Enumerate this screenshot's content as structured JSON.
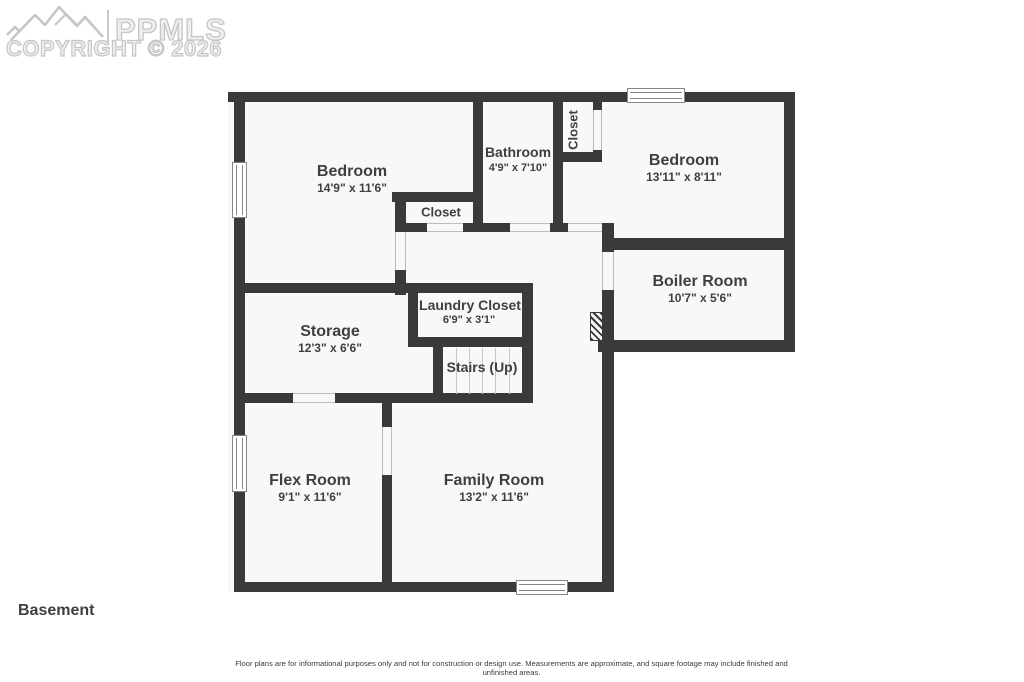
{
  "watermark": {
    "brand": "PPMLS",
    "copyright": "COPYRIGHT © 2026"
  },
  "floor_label": "Basement",
  "disclaimer": "Floor plans are for informational purposes only and not for construction or design use. Measurements are approximate, and square footage may include finished and unfinished areas.",
  "rooms": {
    "bedroom1": {
      "name": "Bedroom",
      "dims": "14'9\" x 11'6\""
    },
    "bathroom": {
      "name": "Bathroom",
      "dims": "4'9\" x 7'10\""
    },
    "closet_b2": {
      "name": "Closet"
    },
    "bedroom2": {
      "name": "Bedroom",
      "dims": "13'11\" x 8'11\""
    },
    "closet_hall": {
      "name": "Closet"
    },
    "boiler": {
      "name": "Boiler Room",
      "dims": "10'7\" x 5'6\""
    },
    "laundry": {
      "name": "Laundry Closet",
      "dims": "6'9\" x 3'1\""
    },
    "storage": {
      "name": "Storage",
      "dims": "12'3\" x 6'6\""
    },
    "stairs": {
      "name": "Stairs (Up)"
    },
    "flex": {
      "name": "Flex Room",
      "dims": "9'1\" x 11'6\""
    },
    "family": {
      "name": "Family Room",
      "dims": "13'2\" x 11'6\""
    }
  },
  "colors": {
    "wall": "#3a3a3c",
    "floor": "#f8f8f6",
    "text": "#3f3f41",
    "watermark": "#c6c6c6"
  }
}
